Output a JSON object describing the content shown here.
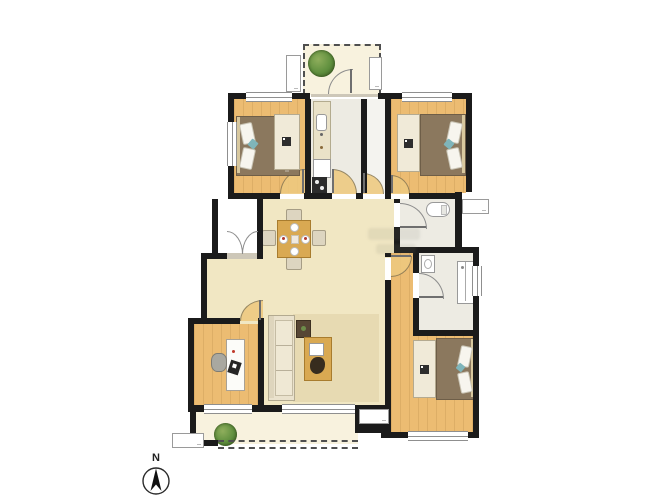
{
  "compass": {
    "north_label": "N"
  },
  "colors": {
    "wall": "#1b1b1b",
    "wood": "#ecbc72",
    "hall": "#f1e7c3",
    "balconyFloor": "#f8f2de",
    "tile": "#edebe3",
    "corridorTile": "#f4f3ef",
    "bed": "#8b785e",
    "wardrobe": "#f0ead8",
    "sofa": "#eae2cd",
    "rug": "#e7dab2",
    "tableWood": "#d9a952",
    "chair": "#ddd5c0",
    "plantGreen": "#5f8f3e",
    "doorFill": "#eec97f",
    "doorLine": "#8a7a55",
    "lineGray": "#8f8f8f",
    "fixtureLine": "#999999"
  },
  "rooms": [
    {
      "name": "balcony-top"
    },
    {
      "name": "bedroom-top-left"
    },
    {
      "name": "kitchen"
    },
    {
      "name": "hallway"
    },
    {
      "name": "bedroom-top-right"
    },
    {
      "name": "bathroom-upper"
    },
    {
      "name": "bathroom-lower"
    },
    {
      "name": "dining-area"
    },
    {
      "name": "living-room"
    },
    {
      "name": "study"
    },
    {
      "name": "bedroom-bottom-right"
    },
    {
      "name": "balcony-bottom"
    },
    {
      "name": "entry-porch"
    }
  ]
}
